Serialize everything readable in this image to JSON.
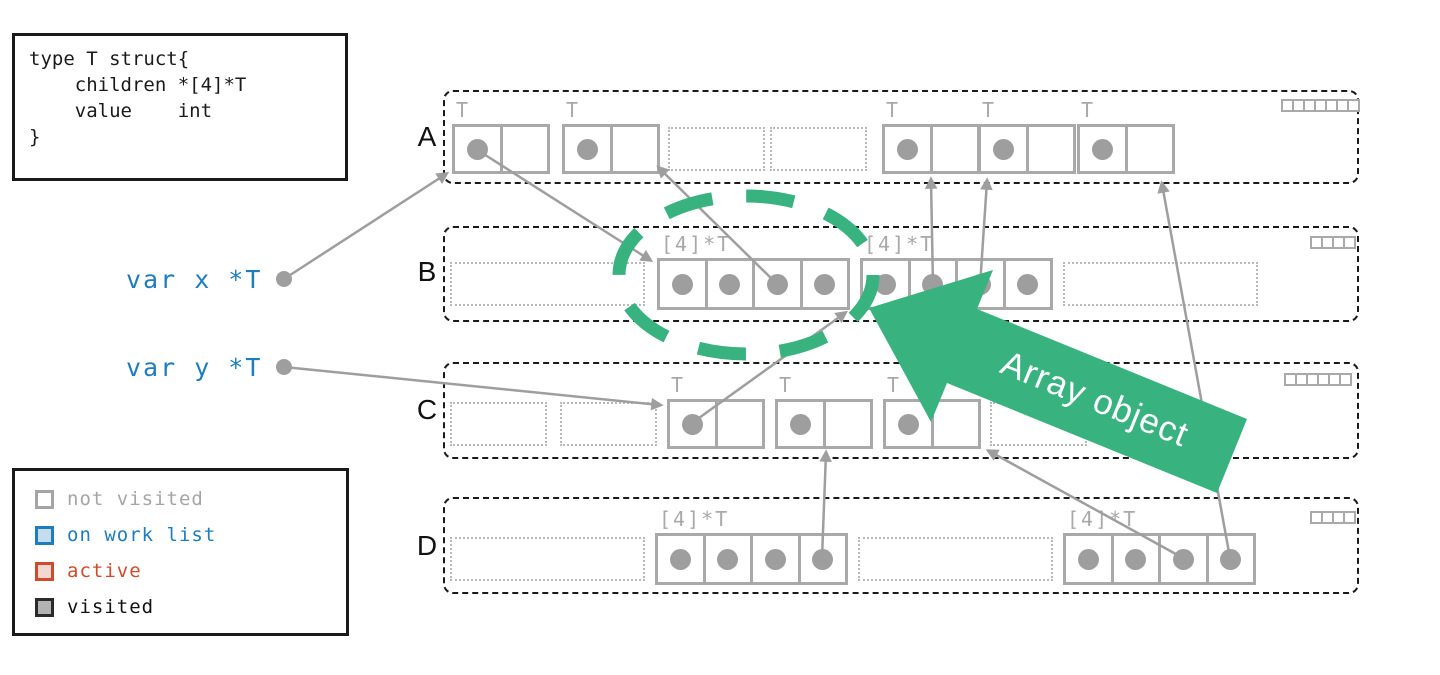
{
  "colors": {
    "accent_green": "#38b27f",
    "pointer_gray": "#9e9e9e",
    "box_border_gray": "#a9a9a9",
    "var_blue": "#1d7dbf",
    "active_red": "#d14a2c",
    "not_visited_gray": "#a5a5a5",
    "visited_black": "#111111"
  },
  "code_box": {
    "text": "type T struct{\n    children *[4]*T\n    value    int\n}"
  },
  "variables": [
    {
      "name": "x",
      "label": "var x *T"
    },
    {
      "name": "y",
      "label": "var y *T"
    }
  ],
  "legend": {
    "items": [
      {
        "label": "not visited",
        "swatch_border": "#a5a5a5",
        "swatch_fill": "#ffffff",
        "text_color": "#a5a5a5"
      },
      {
        "label": "on work list",
        "swatch_border": "#1d7dbf",
        "swatch_fill": "#c4dcee",
        "text_color": "#1d7dbf"
      },
      {
        "label": "active",
        "swatch_border": "#d14a2c",
        "swatch_fill": "#f3d8d1",
        "text_color": "#d14a2c"
      },
      {
        "label": "visited",
        "swatch_border": "#2b2b2b",
        "swatch_fill": "#b3b3b3",
        "text_color": "#111111"
      }
    ]
  },
  "labels": {
    "struct_type": "T",
    "array_type": "[4]*T"
  },
  "annotation": {
    "label": "Array object"
  },
  "regions": [
    {
      "label": "A",
      "bitmap": {
        "x": 1281,
        "y": 99,
        "cells": 7
      },
      "objects": [
        {
          "kind": "struct",
          "x": 452,
          "y": 124,
          "dots": [
            true,
            false
          ]
        },
        {
          "kind": "struct",
          "x": 562,
          "y": 124,
          "dots": [
            true,
            false
          ]
        },
        {
          "kind": "empty_s",
          "x": 668,
          "y": 127
        },
        {
          "kind": "empty_s",
          "x": 770,
          "y": 127
        },
        {
          "kind": "struct",
          "x": 882,
          "y": 124,
          "dots": [
            true,
            false
          ]
        },
        {
          "kind": "struct",
          "x": 978,
          "y": 124,
          "dots": [
            true,
            false
          ]
        },
        {
          "kind": "struct",
          "x": 1077,
          "y": 124,
          "dots": [
            true,
            false
          ]
        }
      ]
    },
    {
      "label": "B",
      "bitmap": {
        "x": 1310,
        "y": 236,
        "cells": 4
      },
      "objects": [
        {
          "kind": "empty_l",
          "x": 450,
          "y": 262
        },
        {
          "kind": "array",
          "x": 657,
          "y": 258,
          "dots": [
            true,
            true,
            true,
            true
          ]
        },
        {
          "kind": "array",
          "x": 860,
          "y": 258,
          "dots": [
            true,
            true,
            true,
            true
          ]
        },
        {
          "kind": "empty_l",
          "x": 1063,
          "y": 262
        }
      ]
    },
    {
      "label": "C",
      "bitmap": {
        "x": 1284,
        "y": 373,
        "cells": 6
      },
      "objects": [
        {
          "kind": "empty_s",
          "x": 450,
          "y": 402
        },
        {
          "kind": "empty_s",
          "x": 560,
          "y": 402
        },
        {
          "kind": "struct",
          "x": 667,
          "y": 399,
          "dots": [
            true,
            false
          ]
        },
        {
          "kind": "struct",
          "x": 775,
          "y": 399,
          "dots": [
            true,
            false
          ]
        },
        {
          "kind": "struct",
          "x": 883,
          "y": 399,
          "dots": [
            true,
            false
          ]
        },
        {
          "kind": "empty_s",
          "x": 990,
          "y": 402
        }
      ]
    },
    {
      "label": "D",
      "bitmap": {
        "x": 1310,
        "y": 511,
        "cells": 4
      },
      "objects": [
        {
          "kind": "empty_l",
          "x": 450,
          "y": 537
        },
        {
          "kind": "array",
          "x": 655,
          "y": 533,
          "dots": [
            true,
            true,
            true,
            true
          ]
        },
        {
          "kind": "empty_l",
          "x": 858,
          "y": 537
        },
        {
          "kind": "array",
          "x": 1063,
          "y": 533,
          "dots": [
            true,
            true,
            true,
            true
          ]
        }
      ]
    }
  ],
  "pointers": [
    {
      "from": "var x",
      "to": "A struct 1",
      "x1": 284,
      "y1": 279,
      "x2": 446,
      "y2": 174,
      "start_dot": true
    },
    {
      "from": "var y",
      "to": "C struct 1",
      "x1": 284,
      "y1": 367,
      "x2": 660,
      "y2": 405,
      "start_dot": true
    },
    {
      "from": "A struct 1",
      "to": "B array 1",
      "x1": 479,
      "y1": 151,
      "x2": 650,
      "y2": 260
    },
    {
      "from": "B array 1 slot 3",
      "to": "A struct 2",
      "x1": 777,
      "y1": 284,
      "x2": 659,
      "y2": 168
    },
    {
      "from": "B array 2 slot 2",
      "to": "A struct 3",
      "x1": 933,
      "y1": 286,
      "x2": 931,
      "y2": 180
    },
    {
      "from": "B array 2 slot 3",
      "to": "A struct 4",
      "x1": 980,
      "y1": 286,
      "x2": 987,
      "y2": 181
    },
    {
      "from": "C struct 1",
      "to": "B array 1",
      "x1": 692,
      "y1": 423,
      "x2": 845,
      "y2": 313
    },
    {
      "from": "D array 1 slot 4",
      "to": "C struct 2",
      "x1": 822,
      "y1": 558,
      "x2": 826,
      "y2": 453
    },
    {
      "from": "D array 2 slot 3",
      "to": "C struct 3",
      "x1": 1183,
      "y1": 558,
      "x2": 989,
      "y2": 451
    },
    {
      "from": "D array 2 slot 4",
      "to": "A struct 5",
      "x1": 1230,
      "y1": 558,
      "x2": 1162,
      "y2": 184
    }
  ],
  "highlight_ellipse": {
    "cx": 746,
    "cy": 275,
    "rx": 127,
    "ry": 79
  },
  "block_arrow": {
    "points": "869,308 993,270 977,309 1247,419 1217,493 947,383 931,422",
    "text_x": 1094,
    "text_y": 401,
    "rotation": 22.2
  }
}
